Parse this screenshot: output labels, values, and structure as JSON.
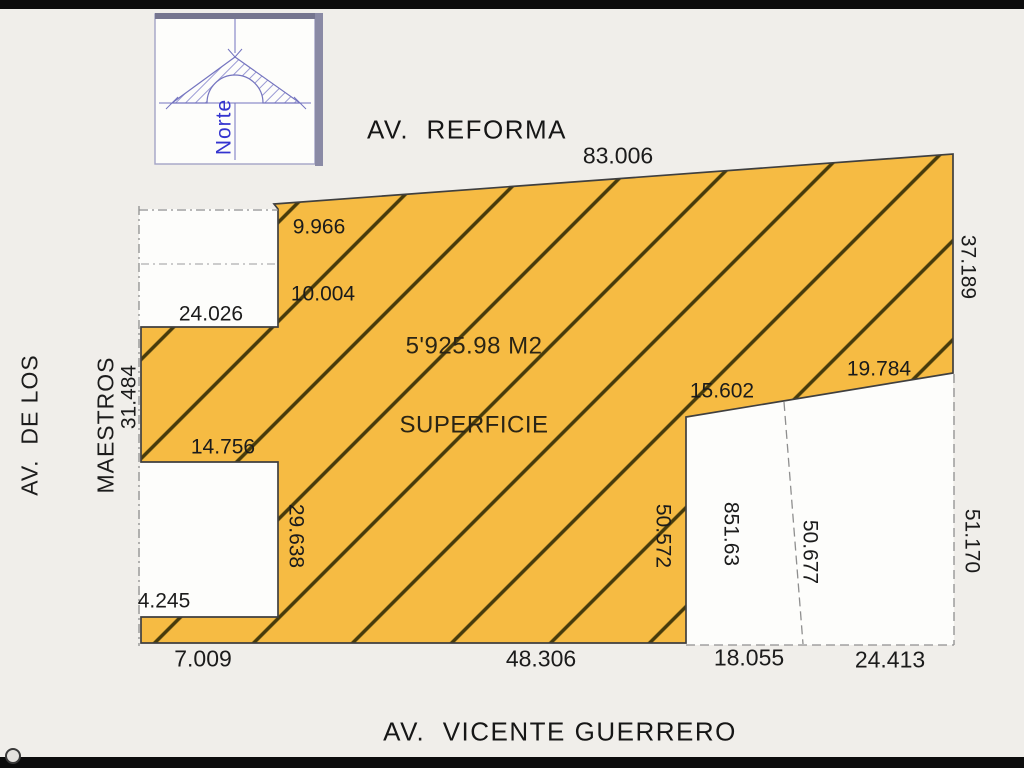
{
  "document": {
    "type": "survey-plan"
  },
  "colors": {
    "background": "#f0eeea",
    "parcel_fill": "#f6bb43",
    "hatch": "#463a0b",
    "outline": "#3f3f3f",
    "dashed": "#8f8f8f",
    "white_lot": "#fdfdfb",
    "north_blue": "#3434cf",
    "text": "#1b1b1b"
  },
  "north_box": {
    "label": "Norte"
  },
  "streets": {
    "top": "AV.  REFORMA",
    "left_line1": "AV.  DE LOS",
    "left_line2": "MAESTROS",
    "bottom": "AV.  VICENTE GUERRERO"
  },
  "parcel": {
    "area_line1": "5'925.98 M2",
    "area_line2": "SUPERFICIE"
  },
  "dims": {
    "top_edge": "83.006",
    "notch1_seg_a": "9.966",
    "notch1_seg_b": "10.004",
    "notch1_bottom": "24.026",
    "left_edge": "31.484",
    "notch2_top": "14.756",
    "notch2_right": "29.638",
    "left_strip": "4.245",
    "bottom_left": "7.009",
    "bottom_main": "48.306",
    "lot_top_left": "15.602",
    "lot_top_right": "19.784",
    "right_upper": "37.189",
    "lot_left_edge": "50.572",
    "lot_area": "851.63",
    "lot_divider": "50.677",
    "right_lower": "51.170",
    "lot_bottom_left": "18.055",
    "lot_bottom_right": "24.413"
  }
}
